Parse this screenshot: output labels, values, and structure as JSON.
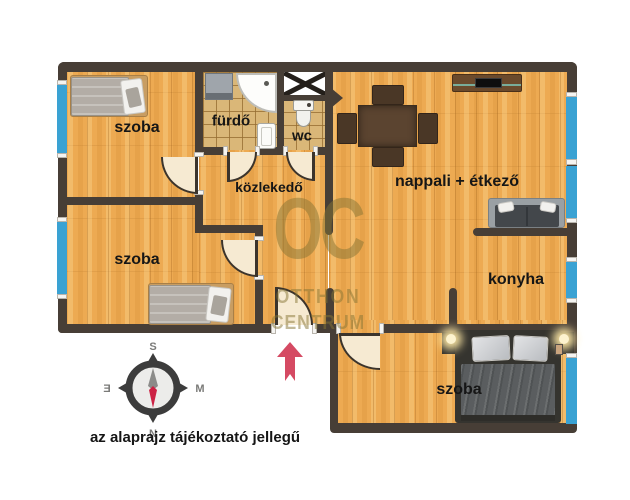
{
  "plan": {
    "rooms": {
      "szoba_top_left": "szoba",
      "szoba_mid_left": "szoba",
      "szoba_bottom": "szoba",
      "furdo": "fürdő",
      "wc": "wc",
      "kozlekedo": "közlekedő",
      "nappali": "nappali + étkező",
      "konyha": "konyha"
    },
    "disclaimer": "az alaprajz tájékoztató jellegű"
  },
  "watermark": {
    "logo": "OC",
    "line1": "OTTHON",
    "line2": "CENTRUM"
  },
  "compass": {
    "top": "S",
    "bottom": "N",
    "left": "Ǝ",
    "right": "M"
  },
  "colors": {
    "wall": "#473e36",
    "window_blue": "#3aa2d3",
    "wood": "#edaa52",
    "tile": "#dab778",
    "door_cream": "#f6ead2",
    "arrow_red": "#d54a63",
    "watermark_olive": "#8a7a3c",
    "label_black": "#161616"
  }
}
